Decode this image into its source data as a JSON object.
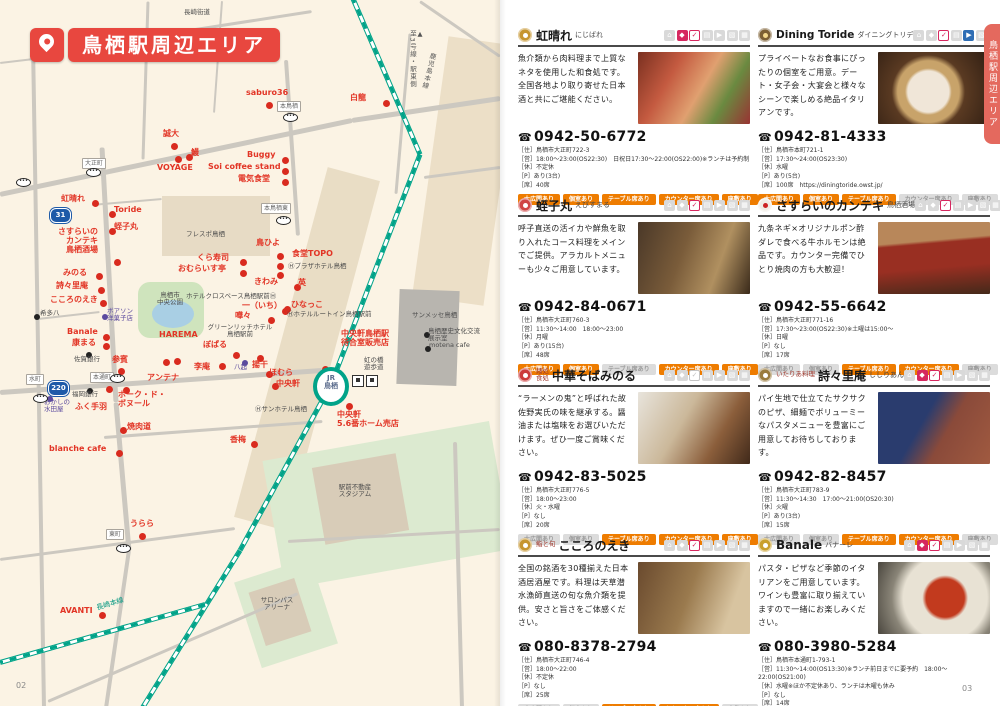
{
  "page_title": "鳥栖駅周辺エリア",
  "left_page": {
    "page_number": "02"
  },
  "right_page": {
    "page_number": "03",
    "side_tab": "鳥栖駅周辺エリア",
    "tag_labels": [
      "大広間あり",
      "個室あり",
      "テーブル席あり",
      "カウンター席あり",
      "座敷あり"
    ],
    "listings": [
      {
        "prefix": "",
        "name": "虹晴れ",
        "kana": "にじばれ",
        "desc": "魚介類から肉料理まで上質なネタを使用した和食処です。全国各地より取り寄せた日本酒と共にご堪能ください。",
        "tel": "0942-50-6772",
        "info": [
          "［住］鳥栖市大正町722-3",
          "［営］18:00～23:00(OS22:30)　日祝日17:30～22:00(OS22:00)※ランチは予約制",
          "［休］不定休",
          "［P］あり(3台)",
          "［席］40席"
        ],
        "icons": [
          "g",
          "r",
          "r",
          "g",
          "g",
          "g",
          "g"
        ],
        "tags": [
          true,
          true,
          true,
          true,
          true
        ],
        "cat": {
          "bg": "#c6952f",
          "c": "#fff"
        }
      },
      {
        "prefix": "",
        "name": "Dining Toride",
        "kana": "ダイニングトリデ",
        "desc": "プライベートなお食事にぴったりの個室をご用意。デート・女子会・大宴会と様々なシーンで楽しめる絶品イタリアンです。",
        "tel": "0942-81-4333",
        "info": [
          "［住］鳥栖市本町721-1",
          "［営］17:30～24:00(OS23:30)",
          "［休］水曜",
          "［P］あり(5台)",
          "［席］100席　https://diningtoride.owst.jp/"
        ],
        "icons": [
          "g",
          "g",
          "r",
          "g",
          "b",
          "g",
          "g"
        ],
        "tags": [
          true,
          true,
          true,
          false,
          false
        ],
        "cat": {
          "bg": "#7d5f33",
          "c": "#f5d98d"
        }
      },
      {
        "prefix": "",
        "name": "蛭子丸",
        "kana": "えびすまる",
        "desc": "呼子直送の活イカや鮮魚を取り入れたコース料理をメインでご提供。アラカルトメニューも少々ご用意しています。",
        "tel": "0942-84-0671",
        "info": [
          "［住］鳥栖市大正町760-3",
          "［営］11:30～14:00　18:00～23:00",
          "［休］月曜",
          "［P］あり(15台)",
          "［席］48席"
        ],
        "icons": [
          "g",
          "g",
          "r",
          "g",
          "g",
          "g",
          "g"
        ],
        "tags": [
          true,
          true,
          false,
          true,
          true
        ],
        "cat": {
          "bg": "#d04545",
          "c": "#fff"
        }
      },
      {
        "prefix": "",
        "name": "さすらいのカンテキ",
        "kana": "鳥栖酒場",
        "desc": "九条ネギ×オリジナルポン酢ダレで食べる牛ホルモンは絶品です。カウンター完備でひとり焼肉の方も大歓迎！",
        "tel": "0942-55-6642",
        "info": [
          "［住］鳥栖市大正町771-16",
          "［営］17:30～23:00(OS22:30)※土曜は15:00～",
          "［休］日曜",
          "［P］なし",
          "［席］17席"
        ],
        "icons": [
          "g",
          "g",
          "r",
          "g",
          "g",
          "g",
          "g"
        ],
        "tags": [
          false,
          false,
          true,
          true,
          false
        ],
        "cat": {
          "bg": "#f0ece4",
          "c": "#cc2222"
        }
      },
      {
        "prefix": "麺処\n食処",
        "name": "中華そばみのる",
        "kana": "",
        "desc": "“ラーメンの鬼”と呼ばれた故佐野実氏の味を継承する。醤油または塩味をお選びいただけます。ぜひ一度ご賞味ください。",
        "tel": "0942-83-5025",
        "info": [
          "［住］鳥栖市大正町776-5",
          "［営］18:00～23:00",
          "［休］火・水曜",
          "［P］なし",
          "［席］20席"
        ],
        "icons": [
          "g",
          "g",
          "g",
          "g",
          "g",
          "g",
          "g"
        ],
        "tags": [
          false,
          false,
          true,
          true,
          true
        ],
        "cat": {
          "bg": "#cc3b3b",
          "c": "#fff"
        }
      },
      {
        "prefix": "いたりあ料理",
        "name": "詩々里庵",
        "kana": "ししりあん",
        "desc": "パイ生地で仕立てたサクサクのピザ、細麺でボリューミーなパスタメニューを豊富にご用意してお待ちしております。",
        "tel": "0942-82-8457",
        "info": [
          "［住］鳥栖市大正町783-9",
          "［営］11:30～14:30　17:00～21:00(OS20:30)",
          "［休］火曜",
          "［P］あり(3台)",
          "［席］15席"
        ],
        "icons": [
          "g",
          "r",
          "r",
          "g",
          "g",
          "g",
          "g"
        ],
        "tags": [
          false,
          false,
          true,
          true,
          false
        ],
        "cat": {
          "bg": "#9a7b3d",
          "c": "#fff"
        }
      },
      {
        "prefix": "鮨と旬",
        "name": "こころのえき",
        "kana": "",
        "desc": "全国の銘酒を30種揃えた日本酒居酒屋です。料理は天草潜水漁師直送の旬な魚介類を提供。安さと旨さをご体感ください。",
        "tel": "080-8378-2794",
        "info": [
          "［住］鳥栖市大正町746-4",
          "［営］18:00～22:00",
          "［休］不定休",
          "［P］なし",
          "［席］25席"
        ],
        "icons": [
          "g",
          "g",
          "r",
          "g",
          "g",
          "g",
          "g"
        ],
        "tags": [
          false,
          false,
          true,
          true,
          false
        ],
        "cat": {
          "bg": "#c6952f",
          "c": "#fff"
        }
      },
      {
        "prefix": "",
        "name": "Banale",
        "kana": "バナーレ",
        "desc": "パスタ・ピザなど季節のイタリアンをご用意しています。ワインも豊富に取り揃えていますので一緒にお楽しみください。",
        "tel": "080-3980-5284",
        "info": [
          "［住］鳥栖市本通町1-793-1",
          "［営］11:30～14:00(OS13:30)※ランチ前日までに要予約　18:00～22:00(OS21:00)",
          "［休］水曜※ほか不定休あり、ランチは木曜も休み",
          "［P］なし",
          "［席］14席"
        ],
        "icons": [
          "g",
          "r",
          "r",
          "g",
          "g",
          "g",
          "g"
        ],
        "tags": [
          false,
          false,
          true,
          true,
          false
        ],
        "cat": {
          "bg": "#c9a02e",
          "c": "#fff"
        }
      }
    ]
  },
  "map": {
    "station_label": "JR\n鳥栖",
    "shields": [
      {
        "n": "31",
        "x": 50,
        "y": 208
      },
      {
        "n": "220",
        "x": 48,
        "y": 381
      }
    ],
    "bus_stops": [
      [
        283,
        113
      ],
      [
        276,
        216
      ],
      [
        86,
        168
      ],
      [
        16,
        178
      ],
      [
        110,
        374
      ],
      [
        33,
        394
      ],
      [
        116,
        544
      ]
    ],
    "labels": [
      {
        "t": "長崎街道",
        "x": 184,
        "y": 9,
        "c": "f"
      },
      {
        "t": "saburo36",
        "x": 246,
        "y": 88,
        "c": "p"
      },
      {
        "t": "白龍",
        "x": 350,
        "y": 93,
        "c": "p"
      },
      {
        "t": "本鳥栖",
        "x": 277,
        "y": 101,
        "c": "bx"
      },
      {
        "t": "本鳥栖東",
        "x": 261,
        "y": 203,
        "c": "bx"
      },
      {
        "t": "誠大",
        "x": 163,
        "y": 129,
        "c": "p"
      },
      {
        "t": "鰻",
        "x": 191,
        "y": 148,
        "c": "p"
      },
      {
        "t": "VOYAGE",
        "x": 157,
        "y": 163,
        "c": "p"
      },
      {
        "t": "Buggy",
        "x": 247,
        "y": 150,
        "c": "p"
      },
      {
        "t": "Soi coffee stand",
        "x": 208,
        "y": 162,
        "c": "p"
      },
      {
        "t": "電気食堂",
        "x": 238,
        "y": 174,
        "c": "p"
      },
      {
        "t": "大正町",
        "x": 82,
        "y": 158,
        "c": "bx"
      },
      {
        "t": "虹晴れ",
        "x": 61,
        "y": 194,
        "c": "p"
      },
      {
        "t": "Toride",
        "x": 114,
        "y": 205,
        "c": "p"
      },
      {
        "t": "蛭子丸",
        "x": 114,
        "y": 222,
        "c": "p"
      },
      {
        "t": "さすらいの\nカンテキ\n鳥栖酒場",
        "x": 50,
        "y": 227,
        "c": "p ra",
        "w": 48
      },
      {
        "t": "みのる",
        "x": 63,
        "y": 268,
        "c": "p"
      },
      {
        "t": "詩々里庵",
        "x": 56,
        "y": 281,
        "c": "p"
      },
      {
        "t": "こころのえき",
        "x": 50,
        "y": 295,
        "c": "p"
      },
      {
        "t": "希多八",
        "x": 40,
        "y": 310,
        "c": "f"
      },
      {
        "t": "ボアソン\n洋菓子店",
        "x": 107,
        "y": 308,
        "c": "pu"
      },
      {
        "t": "Banale",
        "x": 67,
        "y": 327,
        "c": "p"
      },
      {
        "t": "康まる",
        "x": 72,
        "y": 338,
        "c": "p"
      },
      {
        "t": "佐賀銀行",
        "x": 74,
        "y": 356,
        "c": "f"
      },
      {
        "t": "参賓",
        "x": 112,
        "y": 355,
        "c": "p"
      },
      {
        "t": "HAREMA",
        "x": 159,
        "y": 330,
        "c": "p"
      },
      {
        "t": "ぼぱる",
        "x": 203,
        "y": 340,
        "c": "p"
      },
      {
        "t": "李庵",
        "x": 194,
        "y": 362,
        "c": "p"
      },
      {
        "t": "八起",
        "x": 234,
        "y": 364,
        "c": "pu"
      },
      {
        "t": "揚干",
        "x": 252,
        "y": 360,
        "c": "p"
      },
      {
        "t": "ほむら",
        "x": 269,
        "y": 368,
        "c": "p"
      },
      {
        "t": "中央軒",
        "x": 276,
        "y": 379,
        "c": "p"
      },
      {
        "t": "アンテナ",
        "x": 147,
        "y": 373,
        "c": "p"
      },
      {
        "t": "水町",
        "x": 26,
        "y": 374,
        "c": "bx"
      },
      {
        "t": "本通町",
        "x": 90,
        "y": 372,
        "c": "bx"
      },
      {
        "t": "福岡銀行",
        "x": 72,
        "y": 391,
        "c": "f"
      },
      {
        "t": "おかしの\n水田屋",
        "x": 44,
        "y": 399,
        "c": "pu"
      },
      {
        "t": "ふく手羽",
        "x": 75,
        "y": 402,
        "c": "p"
      },
      {
        "t": "ポーク・ド・\nボヌール",
        "x": 118,
        "y": 390,
        "c": "p"
      },
      {
        "t": "焼肉道",
        "x": 127,
        "y": 422,
        "c": "p"
      },
      {
        "t": "blanche cafe",
        "x": 49,
        "y": 444,
        "c": "p"
      },
      {
        "t": "香梅",
        "x": 230,
        "y": 435,
        "c": "p"
      },
      {
        "t": "うらら",
        "x": 130,
        "y": 519,
        "c": "p"
      },
      {
        "t": "東町",
        "x": 106,
        "y": 529,
        "c": "bx"
      },
      {
        "t": "AVANTI",
        "x": 60,
        "y": 606,
        "c": "p"
      },
      {
        "t": "フレスポ鳥栖",
        "x": 186,
        "y": 231,
        "c": "f"
      },
      {
        "t": "くら寿司",
        "x": 197,
        "y": 253,
        "c": "p"
      },
      {
        "t": "おむらいす亭",
        "x": 178,
        "y": 264,
        "c": "p"
      },
      {
        "t": "鳥栖市\n中央公園",
        "x": 170,
        "y": 292,
        "c": "fc"
      },
      {
        "t": "Ⓗプラザホテル鳥栖",
        "x": 288,
        "y": 263,
        "c": "f"
      },
      {
        "t": "鳥ひよ",
        "x": 256,
        "y": 238,
        "c": "p"
      },
      {
        "t": "食堂TOPO",
        "x": 292,
        "y": 249,
        "c": "p"
      },
      {
        "t": "きわみ",
        "x": 254,
        "y": 277,
        "c": "p"
      },
      {
        "t": "英",
        "x": 298,
        "y": 278,
        "c": "p"
      },
      {
        "t": "ホテルクロスベース鳥栖駅前Ⓗ",
        "x": 186,
        "y": 293,
        "c": "f"
      },
      {
        "t": "一（いち）",
        "x": 242,
        "y": 301,
        "c": "p"
      },
      {
        "t": "ひなっこ",
        "x": 291,
        "y": 300,
        "c": "p"
      },
      {
        "t": "嘩々",
        "x": 235,
        "y": 311,
        "c": "p"
      },
      {
        "t": "Ⓗホテルルートイン鳥栖駅前",
        "x": 287,
        "y": 311,
        "c": "f"
      },
      {
        "t": "グリーンリッチホテル\n鳥栖駅前",
        "x": 240,
        "y": 324,
        "c": "fc"
      },
      {
        "t": "中央軒鳥栖駅\n待合室販売店",
        "x": 365,
        "y": 329,
        "c": "pc"
      },
      {
        "t": "サンメッセ鳥栖",
        "x": 412,
        "y": 312,
        "c": "f"
      },
      {
        "t": "鳥栖歴史文化交流\n展示室",
        "x": 428,
        "y": 328,
        "c": "f"
      },
      {
        "t": "motena cafe",
        "x": 429,
        "y": 342,
        "c": "f"
      },
      {
        "t": "虹の橋\n遊歩道",
        "x": 364,
        "y": 357,
        "c": "f"
      },
      {
        "t": "Ⓗサンホテル鳥栖",
        "x": 255,
        "y": 406,
        "c": "f"
      },
      {
        "t": "中央軒\n5.6番ホーム売店",
        "x": 337,
        "y": 410,
        "c": "p"
      },
      {
        "t": "駅前不動産\nスタジアム",
        "x": 355,
        "y": 484,
        "c": "fc"
      },
      {
        "t": "サロンパス\nアリーナ",
        "x": 277,
        "y": 597,
        "c": "fc"
      },
      {
        "t": "▲\n至3号線・駅東側",
        "x": 408,
        "y": 30,
        "c": "v"
      },
      {
        "t": "鹿児島本線",
        "x": 424,
        "y": 52,
        "c": "v tl",
        "r": 14
      },
      {
        "t": "長崎本線",
        "x": 96,
        "y": 600,
        "c": "tl",
        "r": -17
      }
    ],
    "dots_red": [
      [
        266,
        102
      ],
      [
        383,
        100
      ],
      [
        171,
        143
      ],
      [
        175,
        156
      ],
      [
        186,
        154
      ],
      [
        282,
        157
      ],
      [
        282,
        168
      ],
      [
        282,
        179
      ],
      [
        92,
        200
      ],
      [
        109,
        211
      ],
      [
        109,
        228
      ],
      [
        114,
        259
      ],
      [
        96,
        273
      ],
      [
        98,
        287
      ],
      [
        100,
        300
      ],
      [
        103,
        334
      ],
      [
        103,
        343
      ],
      [
        118,
        368
      ],
      [
        163,
        359
      ],
      [
        174,
        358
      ],
      [
        233,
        352
      ],
      [
        219,
        363
      ],
      [
        257,
        355
      ],
      [
        266,
        371
      ],
      [
        272,
        383
      ],
      [
        322,
        366
      ],
      [
        346,
        403
      ],
      [
        240,
        259
      ],
      [
        240,
        270
      ],
      [
        294,
        284
      ],
      [
        277,
        253
      ],
      [
        277,
        263
      ],
      [
        277,
        272
      ],
      [
        282,
        308
      ],
      [
        268,
        317
      ],
      [
        284,
        306
      ],
      [
        106,
        386
      ],
      [
        123,
        387
      ],
      [
        120,
        427
      ],
      [
        116,
        450
      ],
      [
        251,
        441
      ],
      [
        139,
        533
      ],
      [
        99,
        612
      ]
    ],
    "dots_black": [
      [
        34,
        314
      ],
      [
        86,
        352
      ],
      [
        87,
        388
      ],
      [
        424,
        332
      ],
      [
        425,
        346
      ]
    ],
    "dots_purple": [
      [
        102,
        314
      ],
      [
        47,
        396
      ],
      [
        242,
        360
      ]
    ]
  },
  "colors": {
    "accent_red": "#e8473f",
    "tag_orange": "#ee7c00",
    "rail_teal": "#00a389",
    "icon_red": "#d6275f",
    "icon_blue": "#2e6db4"
  }
}
